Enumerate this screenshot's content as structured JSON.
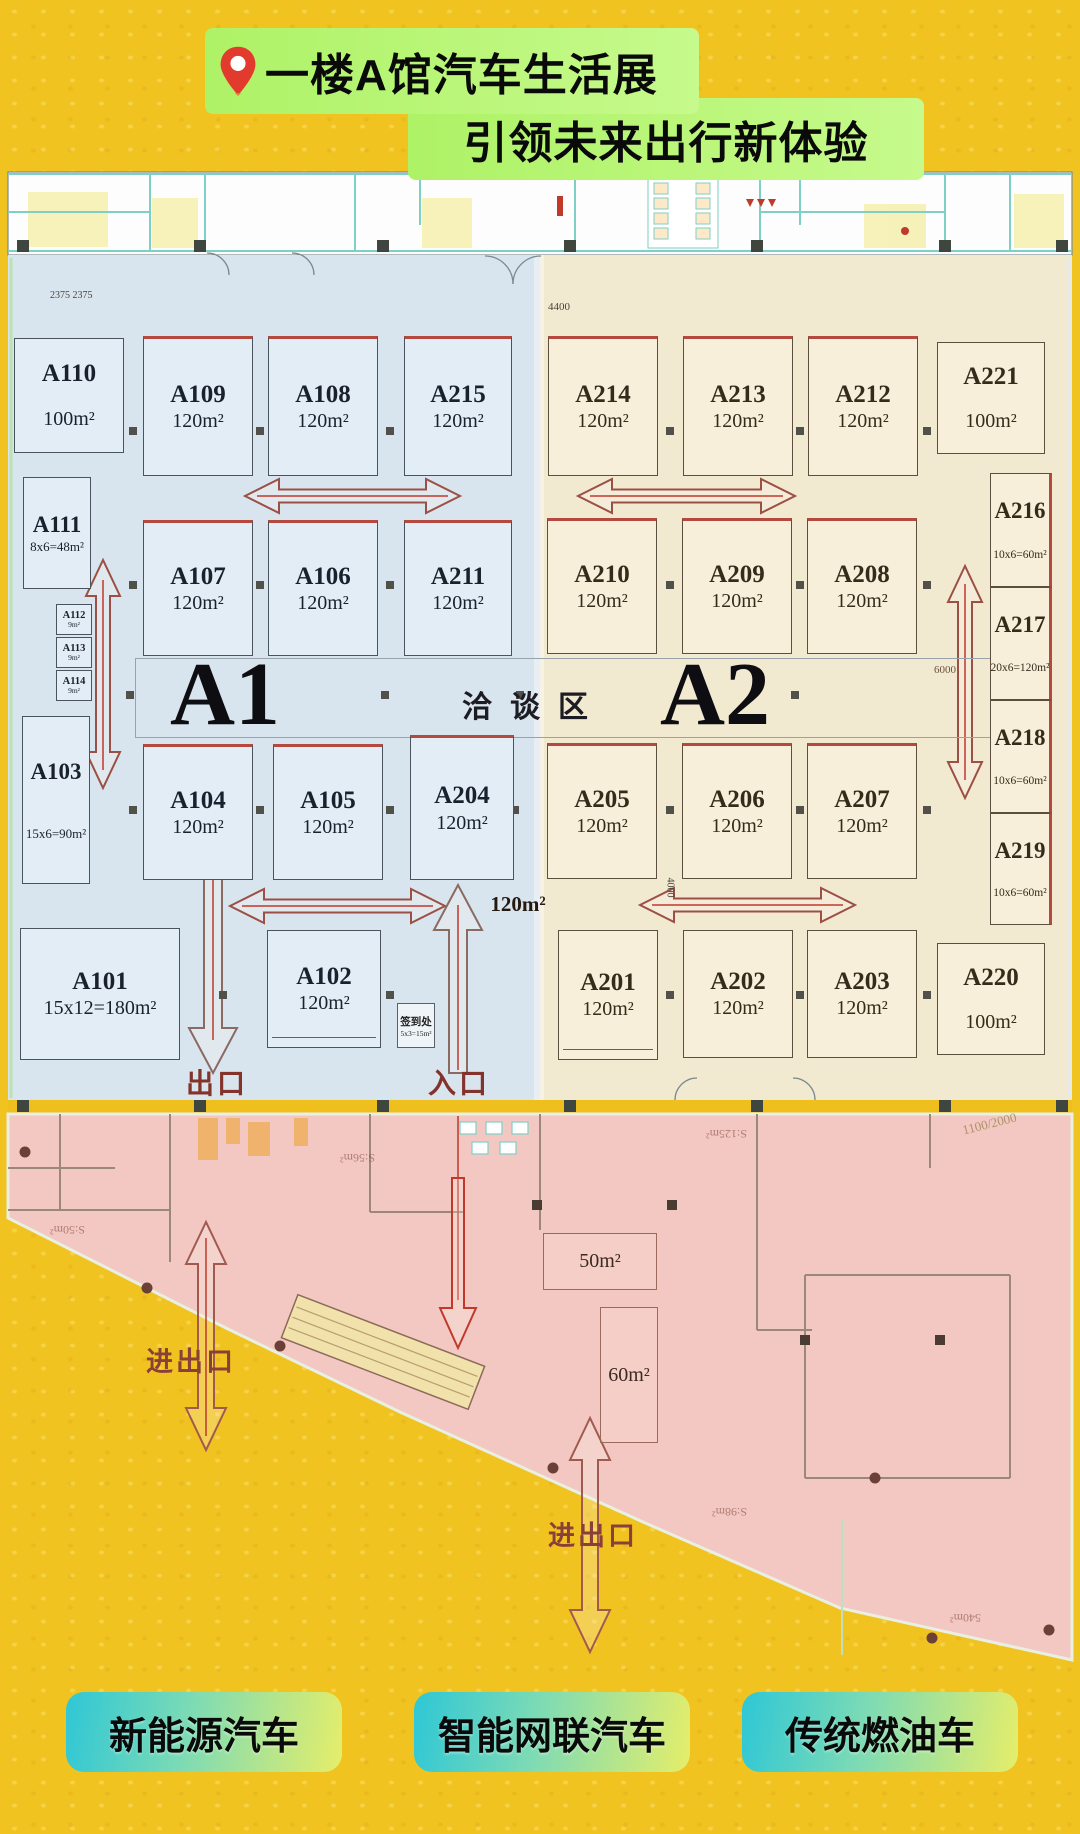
{
  "header": {
    "title_line1": "一楼A馆汽车生活展",
    "title_line2": "引领未来出行新体验",
    "pin_color": "#e23b2e",
    "highlight_color": "#b6f56f"
  },
  "plan": {
    "hall_left_label": "A1",
    "hall_right_label": "A2",
    "negotiation_area_label": "洽谈区",
    "exit_label": "出口",
    "entrance_label": "入口",
    "gate_label_1": "进出口",
    "gate_label_2": "进出口",
    "floating_area_label": "120m²",
    "signin": {
      "name": "签到处",
      "size": "5x3=15m²"
    },
    "dimensions": {
      "top_left": "2375 2375",
      "top_entrance": "4400",
      "right_corridor": "6000",
      "mid_corridor": "4000",
      "pink_right": "1100/2000"
    },
    "booths_a1": [
      {
        "id": "A110",
        "area": "100m²",
        "x": 14,
        "y": 338,
        "w": 110,
        "h": 115,
        "cls": "split"
      },
      {
        "id": "A109",
        "area": "120m²",
        "x": 143,
        "y": 336,
        "w": 110,
        "h": 140,
        "cls": "redtop"
      },
      {
        "id": "A108",
        "area": "120m²",
        "x": 268,
        "y": 336,
        "w": 110,
        "h": 140,
        "cls": "redtop"
      },
      {
        "id": "A215",
        "area": "120m²",
        "x": 404,
        "y": 336,
        "w": 108,
        "h": 140,
        "cls": "redtop"
      },
      {
        "id": "A111",
        "area": "8x6=48m²",
        "x": 23,
        "y": 477,
        "w": 68,
        "h": 112,
        "cls": "mid"
      },
      {
        "id": "A107",
        "area": "120m²",
        "x": 143,
        "y": 520,
        "w": 110,
        "h": 136,
        "cls": "redtop"
      },
      {
        "id": "A106",
        "area": "120m²",
        "x": 268,
        "y": 520,
        "w": 110,
        "h": 136,
        "cls": "redtop"
      },
      {
        "id": "A211",
        "area": "120m²",
        "x": 404,
        "y": 520,
        "w": 108,
        "h": 136,
        "cls": "redtop"
      },
      {
        "id": "A112",
        "area": "9m²",
        "x": 56,
        "y": 604,
        "w": 36,
        "h": 31,
        "cls": "tiny"
      },
      {
        "id": "A113",
        "area": "9m²",
        "x": 56,
        "y": 637,
        "w": 36,
        "h": 31,
        "cls": "tiny"
      },
      {
        "id": "A114",
        "area": "9m²",
        "x": 56,
        "y": 670,
        "w": 36,
        "h": 31,
        "cls": "tiny"
      },
      {
        "id": "A103",
        "area": "15x6=90m²",
        "x": 22,
        "y": 716,
        "w": 68,
        "h": 168,
        "cls": "mid split"
      },
      {
        "id": "A104",
        "area": "120m²",
        "x": 143,
        "y": 744,
        "w": 110,
        "h": 136,
        "cls": "redtop"
      },
      {
        "id": "A105",
        "area": "120m²",
        "x": 273,
        "y": 744,
        "w": 110,
        "h": 136,
        "cls": "redtop"
      },
      {
        "id": "A204",
        "area": "120m²",
        "x": 410,
        "y": 735,
        "w": 104,
        "h": 145,
        "cls": "redtop"
      },
      {
        "id": "A101",
        "area": "15x12=180m²",
        "x": 20,
        "y": 928,
        "w": 160,
        "h": 132,
        "cls": ""
      },
      {
        "id": "A102",
        "area": "120m²",
        "x": 267,
        "y": 930,
        "w": 114,
        "h": 118,
        "cls": "dbl"
      }
    ],
    "booths_a2": [
      {
        "id": "A214",
        "area": "120m²",
        "x": 548,
        "y": 336,
        "w": 110,
        "h": 140,
        "cls": "redtop"
      },
      {
        "id": "A213",
        "area": "120m²",
        "x": 683,
        "y": 336,
        "w": 110,
        "h": 140,
        "cls": "redtop"
      },
      {
        "id": "A212",
        "area": "120m²",
        "x": 808,
        "y": 336,
        "w": 110,
        "h": 140,
        "cls": "redtop"
      },
      {
        "id": "A221",
        "area": "100m²",
        "x": 937,
        "y": 342,
        "w": 108,
        "h": 112,
        "cls": "split"
      },
      {
        "id": "A210",
        "area": "120m²",
        "x": 547,
        "y": 518,
        "w": 110,
        "h": 136,
        "cls": "redtop"
      },
      {
        "id": "A209",
        "area": "120m²",
        "x": 682,
        "y": 518,
        "w": 110,
        "h": 136,
        "cls": "redtop"
      },
      {
        "id": "A208",
        "area": "120m²",
        "x": 807,
        "y": 518,
        "w": 110,
        "h": 136,
        "cls": "redtop"
      },
      {
        "id": "A216",
        "area": "10x6=60m²",
        "x": 990,
        "y": 473,
        "w": 62,
        "h": 114,
        "cls": "side split"
      },
      {
        "id": "A217",
        "area": "20x6=120m²",
        "x": 990,
        "y": 587,
        "w": 62,
        "h": 113,
        "cls": "side split"
      },
      {
        "id": "A218",
        "area": "10x6=60m²",
        "x": 990,
        "y": 700,
        "w": 62,
        "h": 113,
        "cls": "side split"
      },
      {
        "id": "A219",
        "area": "10x6=60m²",
        "x": 990,
        "y": 813,
        "w": 62,
        "h": 112,
        "cls": "side split"
      },
      {
        "id": "A205",
        "area": "120m²",
        "x": 547,
        "y": 743,
        "w": 110,
        "h": 136,
        "cls": "redtop"
      },
      {
        "id": "A206",
        "area": "120m²",
        "x": 682,
        "y": 743,
        "w": 110,
        "h": 136,
        "cls": "redtop"
      },
      {
        "id": "A207",
        "area": "120m²",
        "x": 807,
        "y": 743,
        "w": 110,
        "h": 136,
        "cls": "redtop"
      },
      {
        "id": "A201",
        "area": "120m²",
        "x": 558,
        "y": 930,
        "w": 100,
        "h": 130,
        "cls": "dbl"
      },
      {
        "id": "A202",
        "area": "120m²",
        "x": 683,
        "y": 930,
        "w": 110,
        "h": 128,
        "cls": ""
      },
      {
        "id": "A203",
        "area": "120m²",
        "x": 807,
        "y": 930,
        "w": 110,
        "h": 128,
        "cls": ""
      },
      {
        "id": "A220",
        "area": "100m²",
        "x": 937,
        "y": 943,
        "w": 108,
        "h": 112,
        "cls": "split"
      }
    ],
    "pink_rooms": [
      {
        "label": "50m²",
        "x": 543,
        "y": 1233,
        "w": 114,
        "h": 57
      },
      {
        "label": "60m²",
        "x": 600,
        "y": 1307,
        "w": 58,
        "h": 136
      }
    ],
    "ghost_labels": [
      {
        "text": "S:50m²",
        "x": 50,
        "y": 1222,
        "rot": 180
      },
      {
        "text": "S:56m²",
        "x": 340,
        "y": 1150,
        "rot": 180
      },
      {
        "text": "S:125m²",
        "x": 706,
        "y": 1126,
        "rot": 180
      },
      {
        "text": "S:98m²",
        "x": 712,
        "y": 1504,
        "rot": 180
      },
      {
        "text": "540m²",
        "x": 950,
        "y": 1610,
        "rot": 180
      }
    ]
  },
  "legend": {
    "items": [
      {
        "label": "新能源汽车"
      },
      {
        "label": "智能网联汽车"
      },
      {
        "label": "传统燃油车"
      }
    ]
  }
}
